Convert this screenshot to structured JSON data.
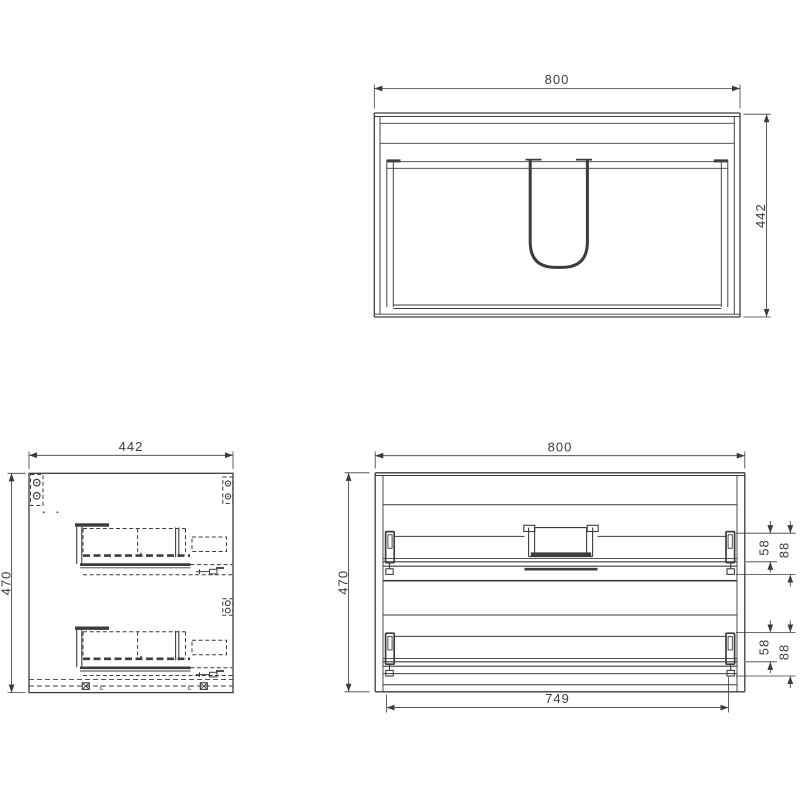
{
  "colors": {
    "line": "#3c3c3c",
    "background": "#ffffff"
  },
  "top_view": {
    "label_width": "800",
    "label_depth": "442"
  },
  "side_view": {
    "label_width": "442",
    "label_height": "470",
    "cam_marks": [
      "c",
      "c"
    ]
  },
  "rear_view": {
    "label_width": "800",
    "label_height": "470",
    "label_inner_width": "749",
    "upper_drawer": {
      "label_back_offset": "58",
      "label_slide_offset": "88"
    },
    "lower_drawer": {
      "label_back_offset": "58",
      "label_slide_offset": "88"
    }
  }
}
